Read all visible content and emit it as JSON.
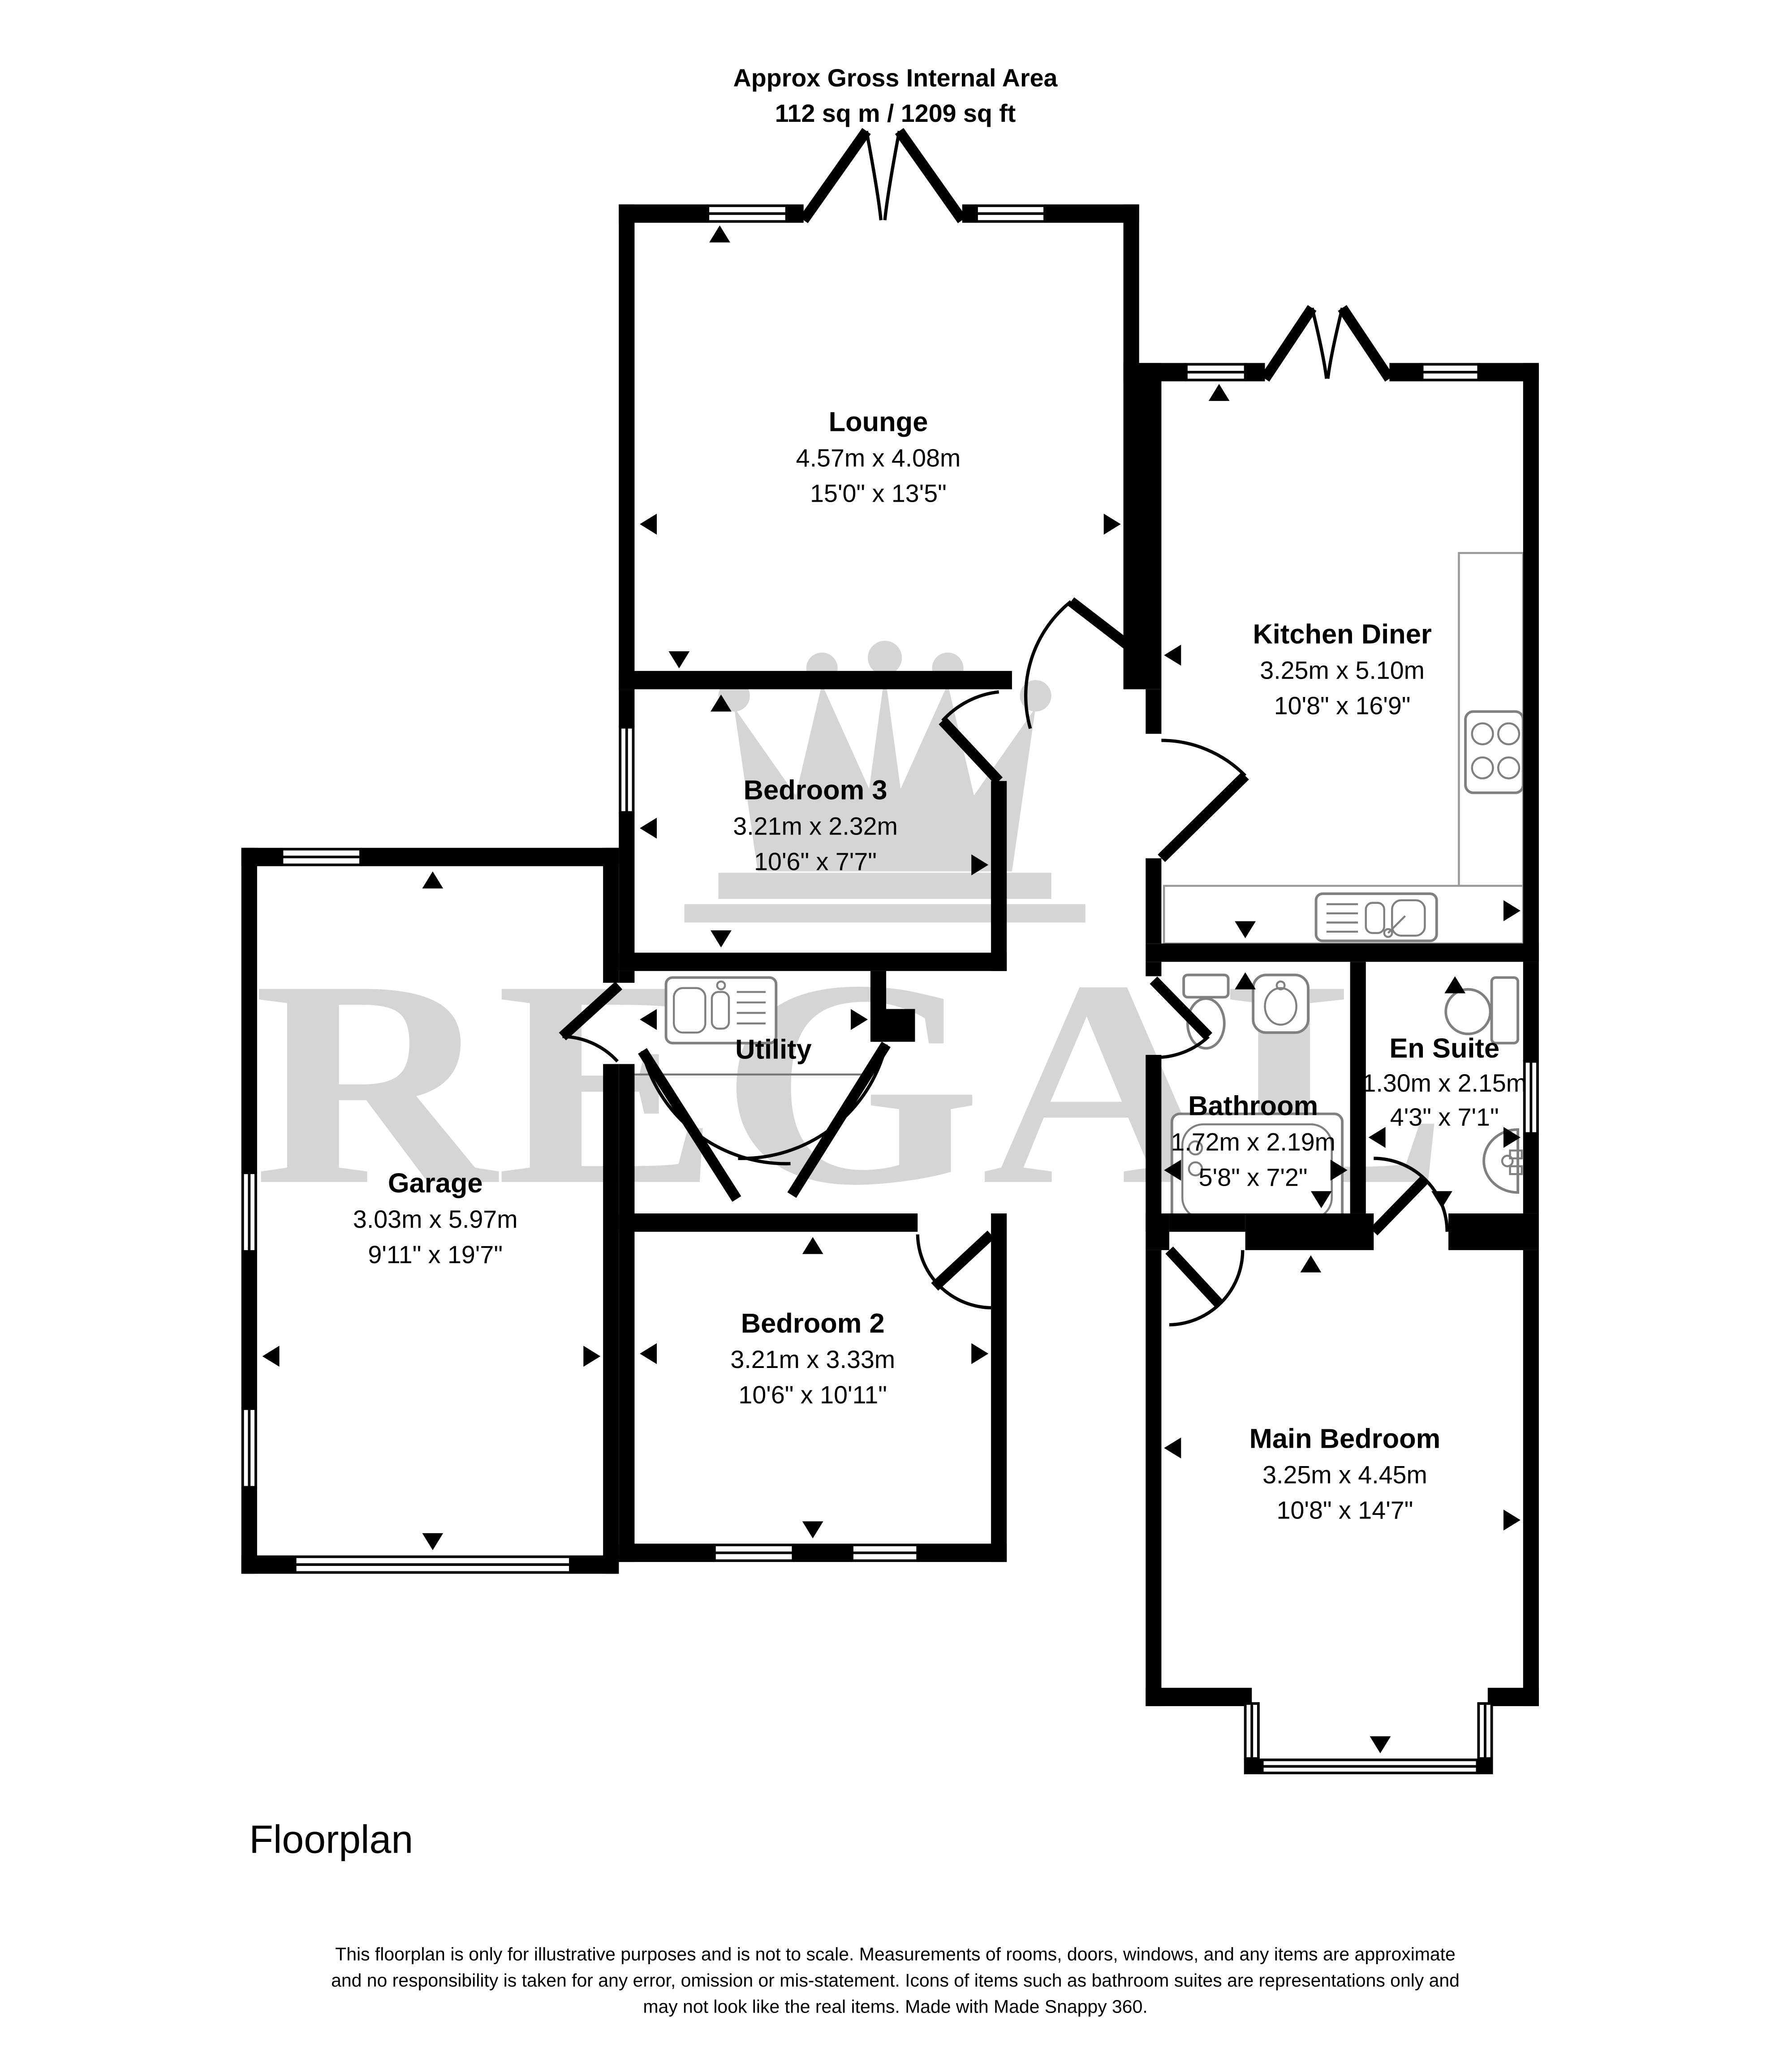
{
  "header": {
    "line1": "Approx Gross Internal Area",
    "line2": "112 sq m / 1209 sq ft"
  },
  "watermark": {
    "brand": "REGAL",
    "icon": "crown-icon"
  },
  "rooms": {
    "lounge": {
      "name": "Lounge",
      "metric": "4.57m x 4.08m",
      "imperial": "15'0\" x 13'5\""
    },
    "kitchen_diner": {
      "name": "Kitchen Diner",
      "metric": "3.25m x 5.10m",
      "imperial": "10'8\" x 16'9\""
    },
    "bedroom3": {
      "name": "Bedroom 3",
      "metric": "3.21m x 2.32m",
      "imperial": "10'6\" x 7'7\""
    },
    "utility": {
      "name": "Utility"
    },
    "garage": {
      "name": "Garage",
      "metric": "3.03m x 5.97m",
      "imperial": "9'11\" x 19'7\""
    },
    "bathroom": {
      "name": "Bathroom",
      "metric": "1.72m x 2.19m",
      "imperial": "5'8\" x 7'2\""
    },
    "en_suite": {
      "name": "En Suite",
      "metric": "1.30m x 2.15m",
      "imperial": "4'3\" x 7'1\""
    },
    "bedroom2": {
      "name": "Bedroom 2",
      "metric": "3.21m x 3.33m",
      "imperial": "10'6\" x 10'11\""
    },
    "main_bedroom": {
      "name": "Main Bedroom",
      "metric": "3.25m x 4.45m",
      "imperial": "10'8\" x 14'7\""
    }
  },
  "footer": {
    "title": "Floorplan",
    "disclaimer_line1": "This floorplan is only for illustrative purposes and is not to scale. Measurements of rooms, doors, windows, and any items are approximate",
    "disclaimer_line2": "and no responsibility is taken for any error, omission or mis-statement. Icons of items such as bathroom suites are representations only and",
    "disclaimer_line3": "may not look like the real items. Made with Made Snappy 360."
  },
  "colors": {
    "wall": "#000000",
    "watermark": "#d5d5d5",
    "fixture_stroke": "#808080",
    "background": "#ffffff"
  }
}
